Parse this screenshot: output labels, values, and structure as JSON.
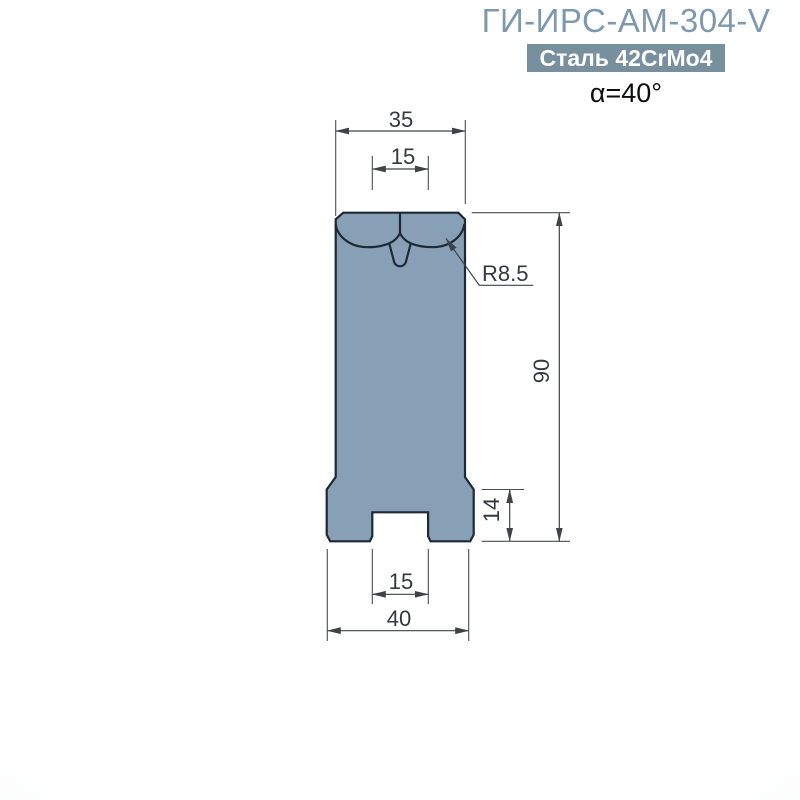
{
  "header": {
    "model": "ГИ-ИРС-АМ-304-V",
    "material": "Сталь 42CrMo4",
    "angle": "α=40°"
  },
  "dimensions": {
    "top_width": "35",
    "v_opening": "15",
    "shoulder_radius": "R8.5",
    "total_height": "90",
    "base_height": "14",
    "slot_width": "15",
    "base_width": "40"
  },
  "colors": {
    "body_fill": "#87A0B5",
    "body_outline": "#1D2935",
    "title_text": "#7E98AE",
    "badge_background": "#78909E",
    "badge_text": "#FFFFFF",
    "dimension_lines": "#3F4348",
    "dimension_text": "#35393E",
    "background": "#FFFFFF"
  },
  "drawing": {
    "type": "technical-front-view",
    "subject": "press-brake V-die profile"
  }
}
